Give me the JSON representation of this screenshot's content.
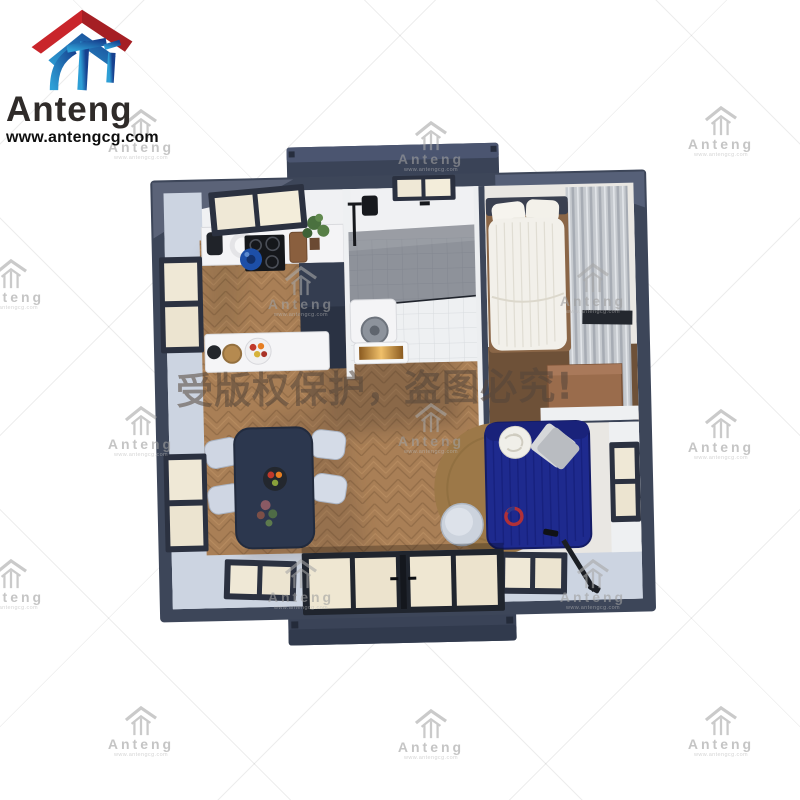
{
  "logo": {
    "name": "Anteng",
    "website": "www.antengcg.com"
  },
  "watermark": {
    "label": "Anteng",
    "url": "www.antengcg.com",
    "copyright_notice": "受版权保护，盗图必究!"
  },
  "colors": {
    "brand_red": "#c9252b",
    "brand_red_dark": "#a51f24",
    "brand_blue": "#1c55a4",
    "navy": "#3d4659",
    "navy_dark": "#2a3243",
    "wall_light": "#ccd4e1",
    "wall_white": "#f0f1f3",
    "floor_wood": "#a97f56",
    "sofa_blue": "#1e2a8e",
    "rug_brown": "#9c7848",
    "desk_wood": "#9a6c4c",
    "bed_white": "#f2f0ea",
    "amber_glow": "#f0c06a",
    "watermark_gray": "#a0a0a0",
    "copyright_color": "rgba(84,70,58,0.55)"
  }
}
